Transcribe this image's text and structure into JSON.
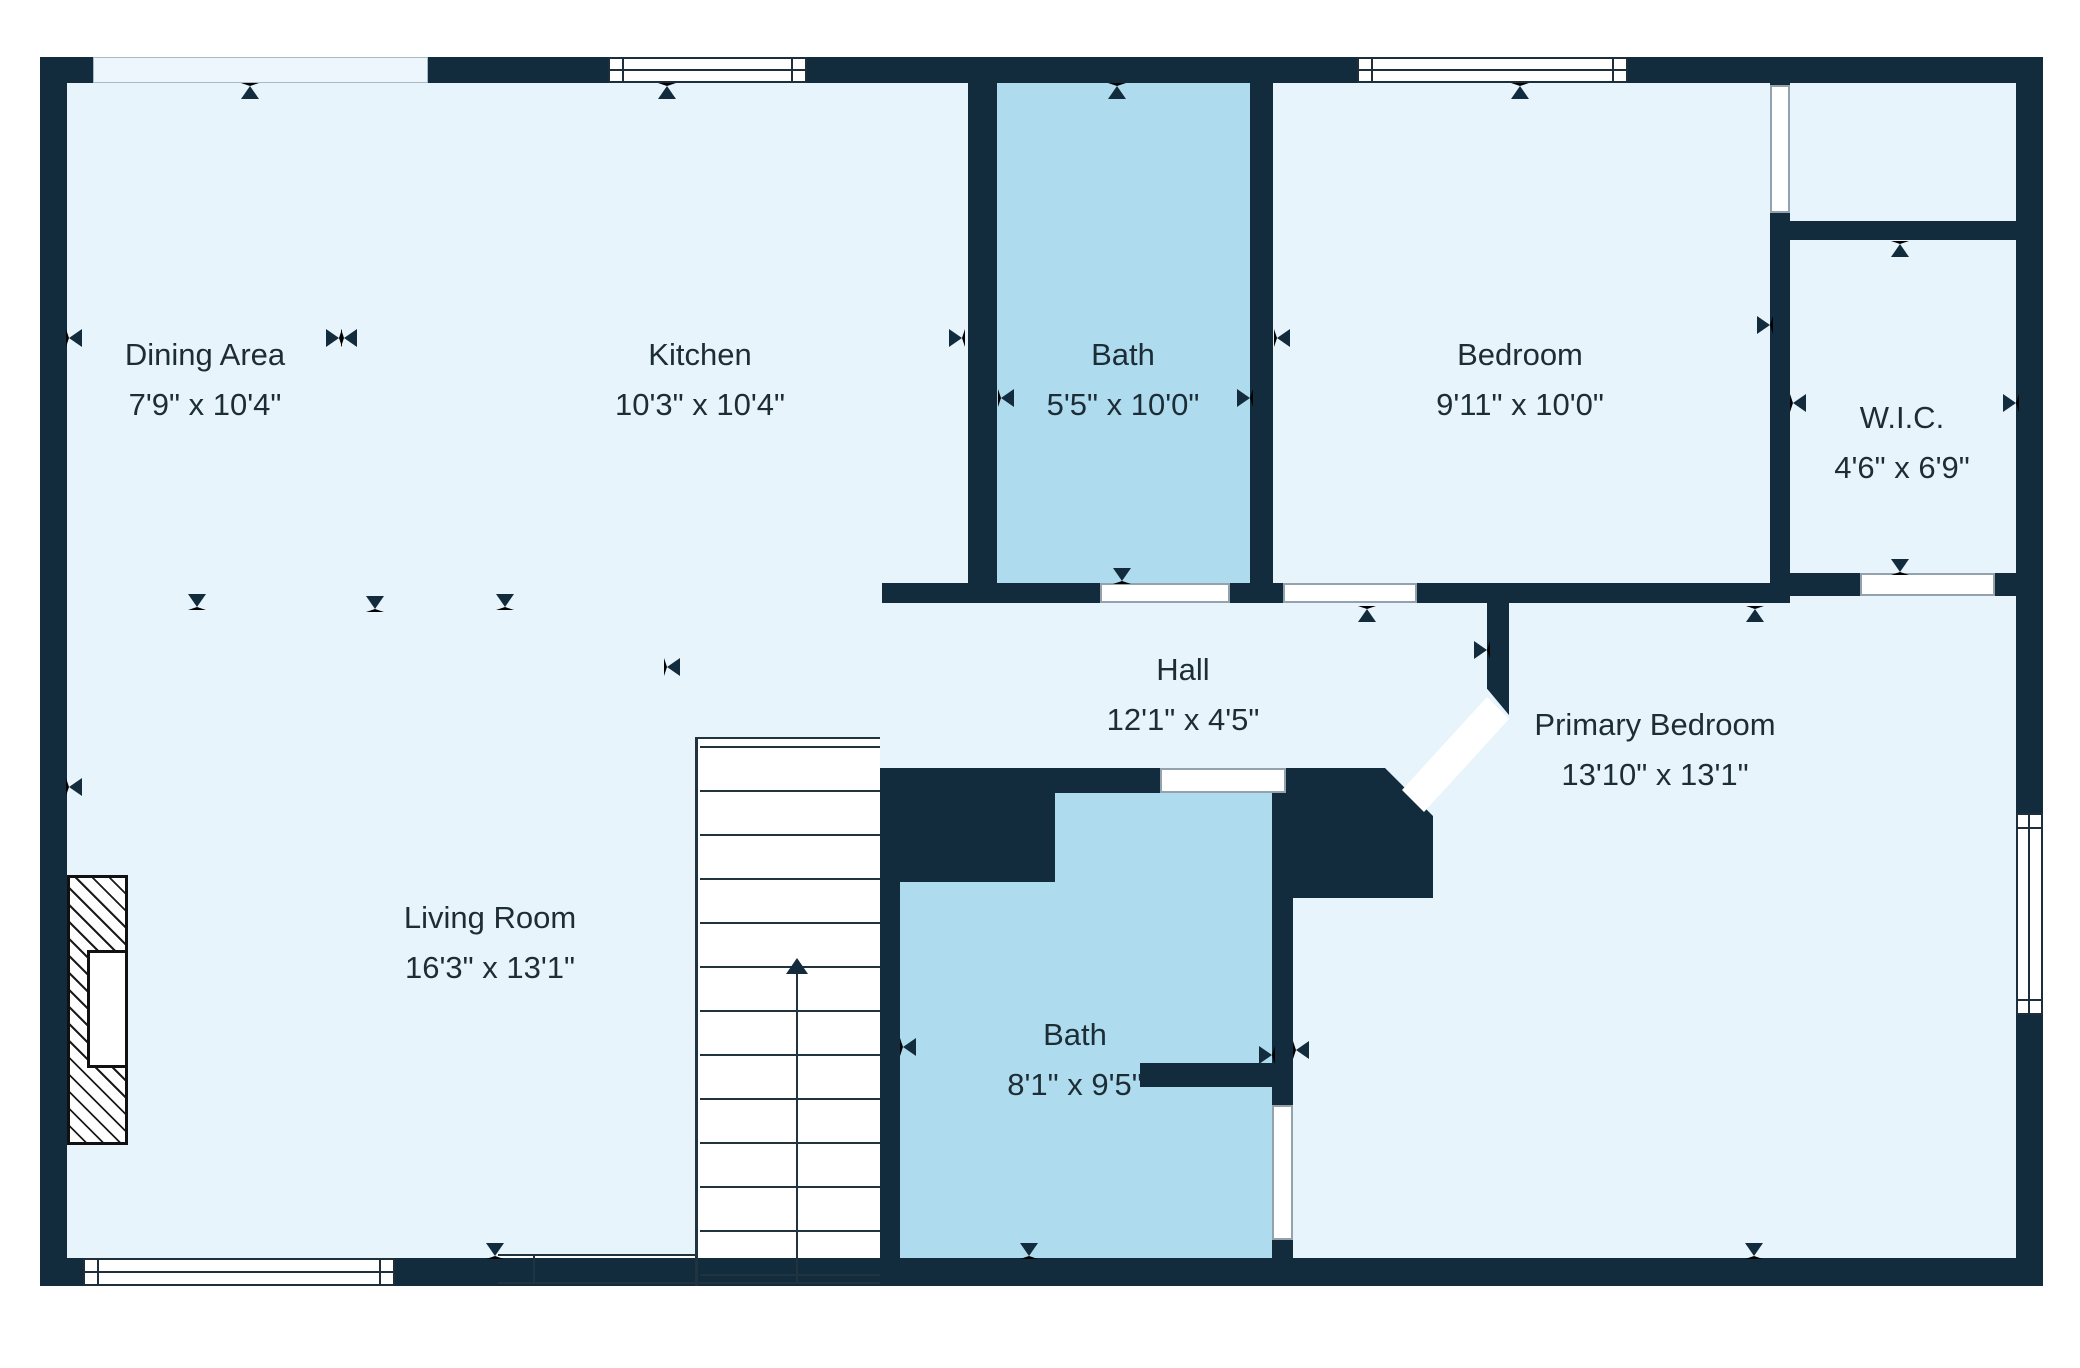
{
  "plan": {
    "type": "floor-plan",
    "units": "feet-inches"
  },
  "colors": {
    "wall": "#132c3d",
    "room_fill": "#e8f4fb",
    "bath_fill": "#aedcee",
    "window_fill": "#ffffff",
    "light_strip": "#edf6fc",
    "text": "#1d2d36",
    "background": "#ffffff"
  },
  "rooms": [
    {
      "id": "dining-area",
      "name": "Dining Area",
      "dims": "7'9\" x 10'4\""
    },
    {
      "id": "kitchen",
      "name": "Kitchen",
      "dims": "10'3\" x 10'4\""
    },
    {
      "id": "bath-top",
      "name": "Bath",
      "dims": "5'5\" x 10'0\""
    },
    {
      "id": "bedroom",
      "name": "Bedroom",
      "dims": "9'11\" x 10'0\""
    },
    {
      "id": "wic",
      "name": "W.I.C.",
      "dims": "4'6\" x 6'9\""
    },
    {
      "id": "hall",
      "name": "Hall",
      "dims": "12'1\" x 4'5\""
    },
    {
      "id": "living-room",
      "name": "Living Room",
      "dims": "16'3\" x 13'1\""
    },
    {
      "id": "bath-bottom",
      "name": "Bath",
      "dims": "8'1\" x 9'5\""
    },
    {
      "id": "primary-bedroom",
      "name": "Primary Bedroom",
      "dims": "13'10\" x 13'1\""
    }
  ],
  "features": {
    "stairs_icon": "arrow-up-icon",
    "fireplace": "hatched",
    "door_markers": "triangle-arrows"
  }
}
